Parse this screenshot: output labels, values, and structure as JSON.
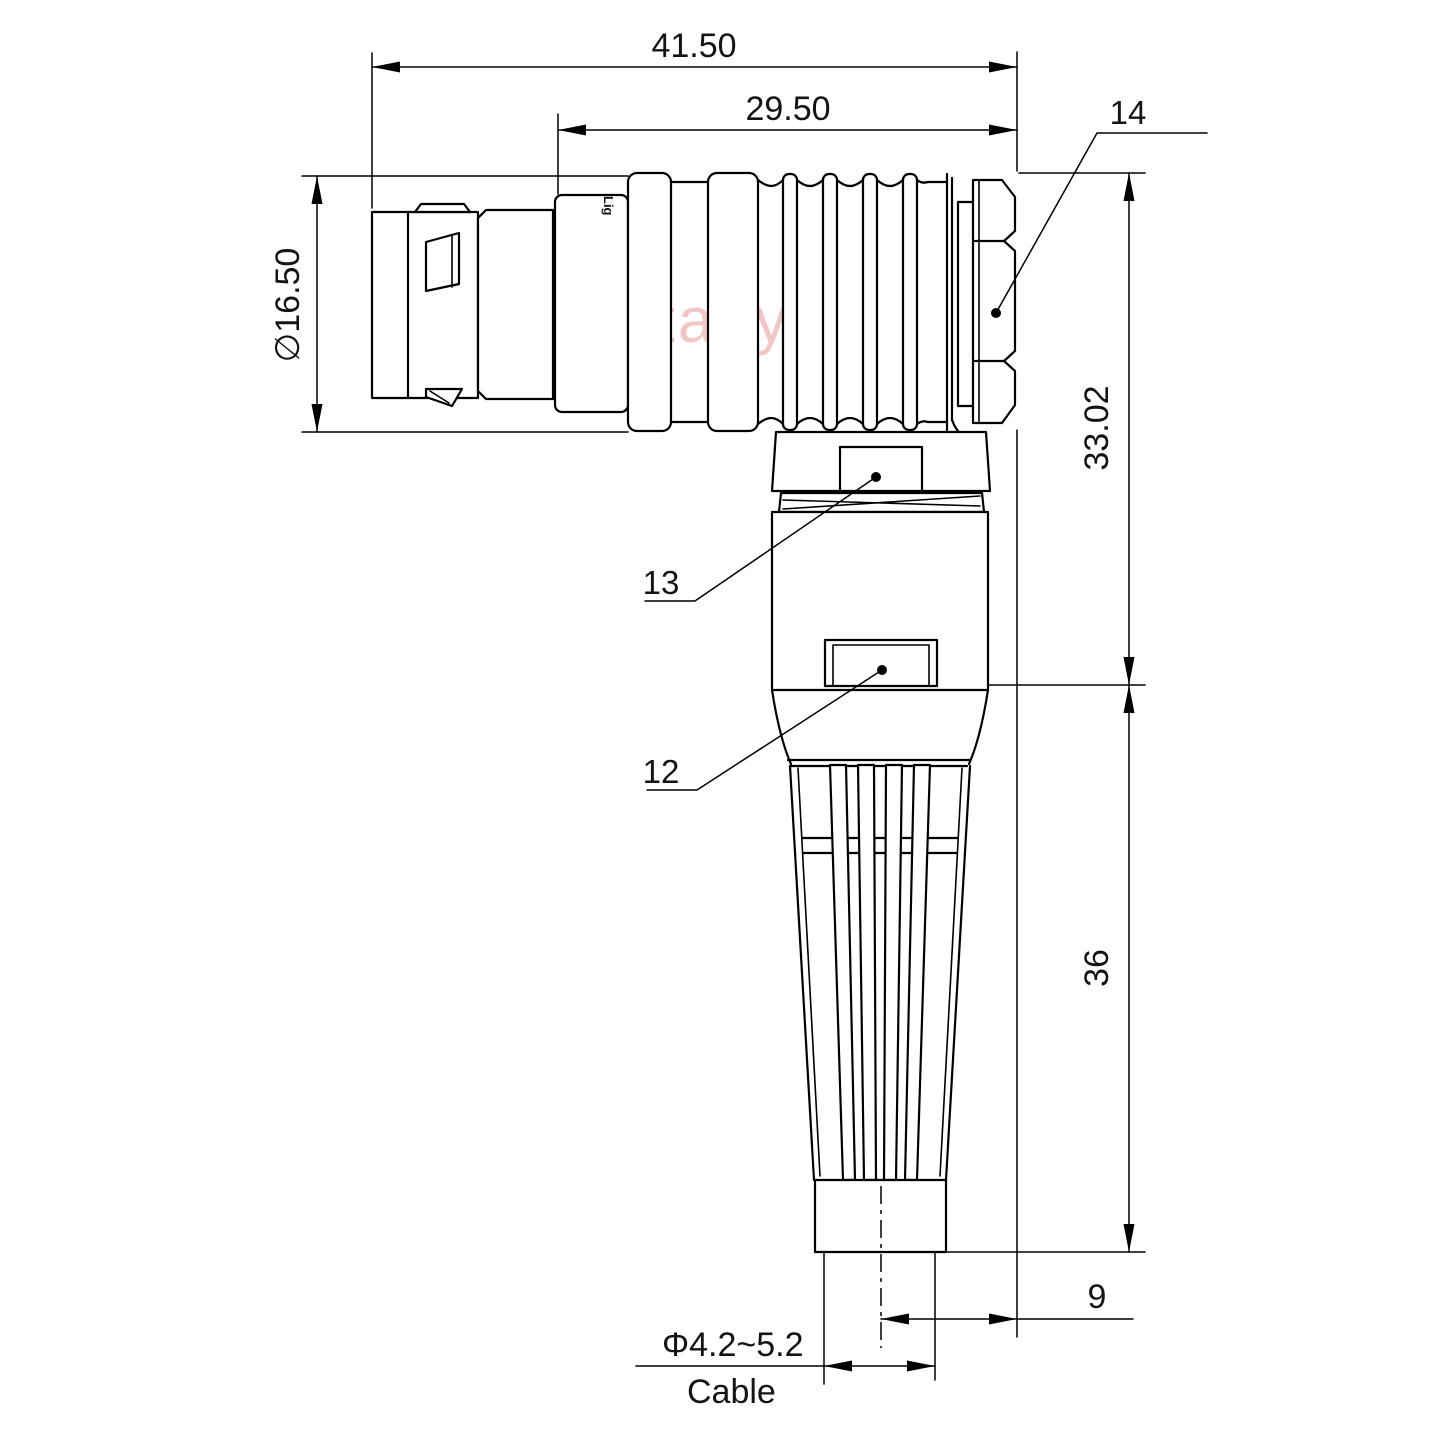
{
  "watermark": "Lightany",
  "body_logo": "Lig",
  "dimensions": {
    "overall_length": "41.50",
    "rear_length": "29.50",
    "shell_diameter": "∅16.50",
    "upper_height": "33.02",
    "lower_height": "36",
    "nut_offset": "9",
    "cable_range": "Φ4.2~5.2",
    "cable_label": "Cable"
  },
  "part_labels": {
    "backnut": "14",
    "coupling_ring": "13",
    "housing": "12"
  },
  "colors": {
    "line": "#000000",
    "text": "#141414",
    "watermark": "#eeb4b4",
    "background": "#ffffff"
  }
}
